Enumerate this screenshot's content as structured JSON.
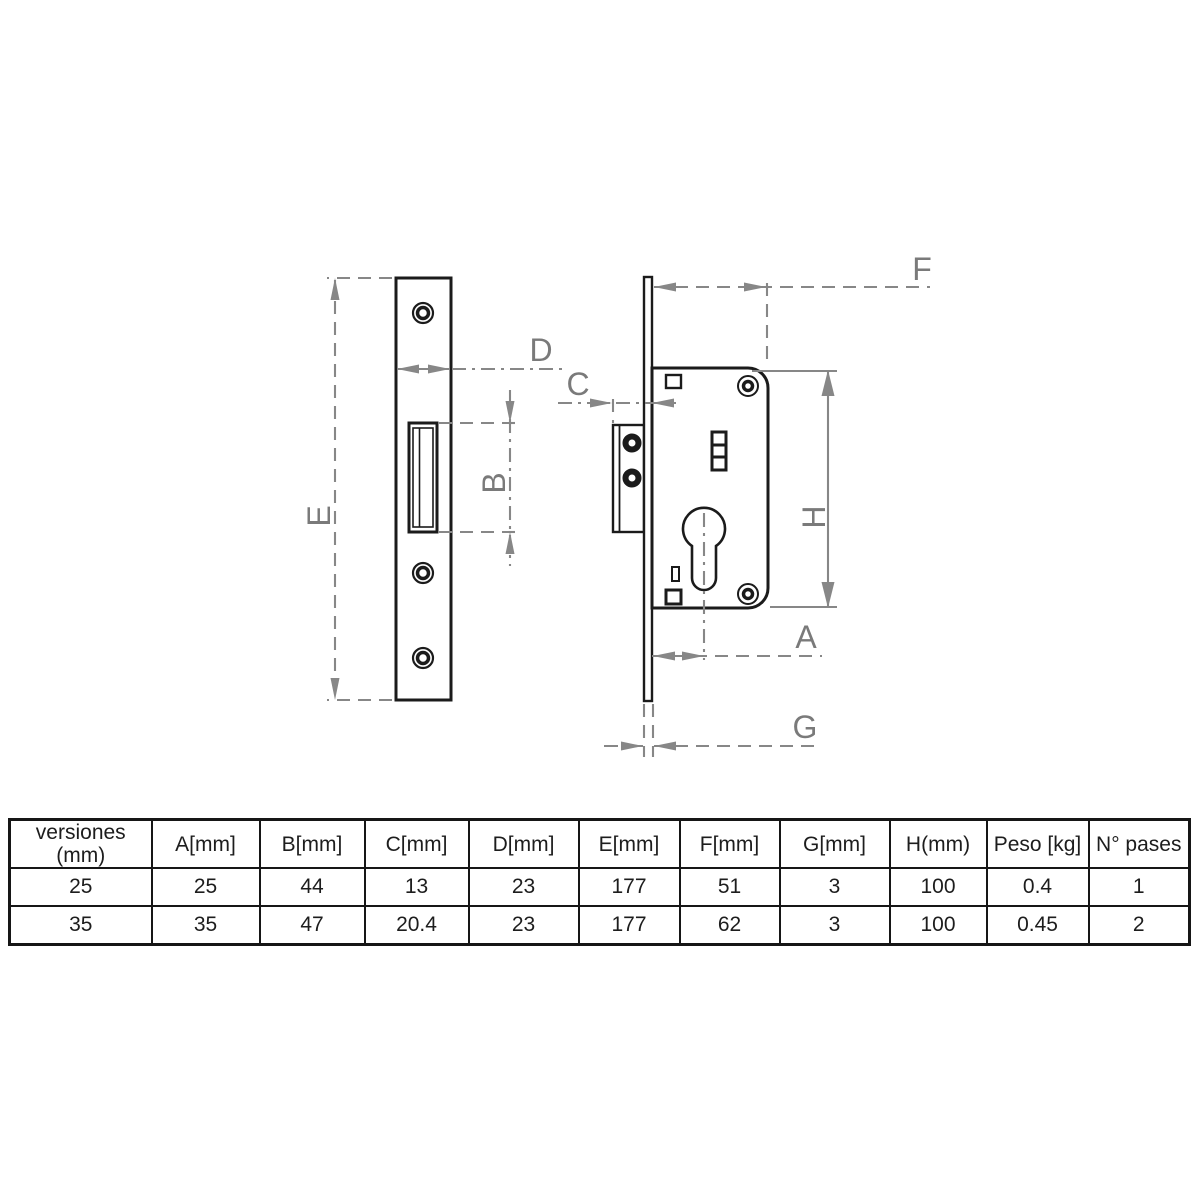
{
  "diagram": {
    "labels": {
      "A": "A",
      "B": "B",
      "C": "C",
      "D": "D",
      "E": "E",
      "F": "F",
      "G": "G",
      "H": "H"
    }
  },
  "colors": {
    "part_outline": "#1b1b1b",
    "dimension_gray": "#878787",
    "table_border": "#161616",
    "background": "#ffffff"
  },
  "table": {
    "headers": [
      {
        "line1": "versiones",
        "line2": "(mm)"
      },
      "A[mm]",
      "B[mm]",
      "C[mm]",
      "D[mm]",
      "E[mm]",
      "F[mm]",
      "G[mm]",
      "H(mm)",
      "Peso [kg]",
      "N° pases"
    ],
    "rows": [
      [
        "25",
        "25",
        "44",
        "13",
        "23",
        "177",
        "51",
        "3",
        "100",
        "0.4",
        "1"
      ],
      [
        "35",
        "35",
        "47",
        "20.4",
        "23",
        "177",
        "62",
        "3",
        "100",
        "0.45",
        "2"
      ]
    ]
  }
}
